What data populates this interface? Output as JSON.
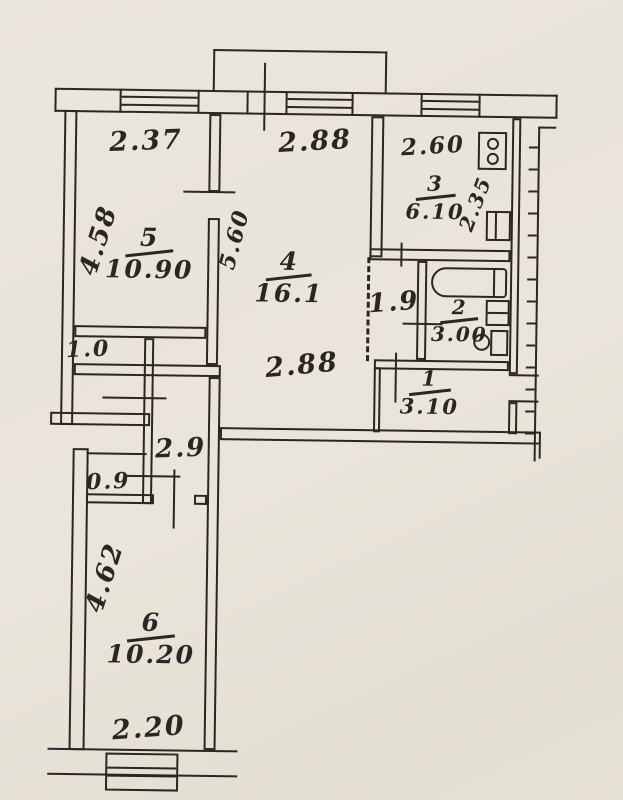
{
  "document": {
    "kind": "scanned apartment floor plan",
    "paper_color": "#e9e4d9",
    "ink_color": "#2b2620"
  },
  "plan": {
    "rooms": {
      "room5": {
        "number": "5",
        "area": "10.90",
        "width": "2.37",
        "depth": "4.58"
      },
      "room4": {
        "number": "4",
        "area": "16.1",
        "width_top": "2.88",
        "width_bottom": "2.88",
        "depth": "5.60"
      },
      "kitchen": {
        "number": "3",
        "area": "6.10",
        "width": "2.60",
        "depth": "2.35"
      },
      "bathroom": {
        "number": "2",
        "area": "3.00"
      },
      "hallway": {
        "number": "1",
        "area": "3.10"
      },
      "room6": {
        "number": "6",
        "area": "10.20",
        "depth": "4.62",
        "width": "2.20"
      },
      "corridor_upper": {
        "width": "1.9"
      },
      "corridor_lower": {
        "length": "2.9"
      },
      "closet_upper": {
        "width": "1.0"
      },
      "closet_lower": {
        "width": "0.9"
      }
    },
    "fixtures": {
      "stove": "stove",
      "kitchen_sink": "kitchen-sink",
      "bathtub": "bathtub",
      "wash_basin": "wash-basin",
      "toilet": "toilet",
      "balcony": "balcony",
      "window": "window"
    }
  }
}
